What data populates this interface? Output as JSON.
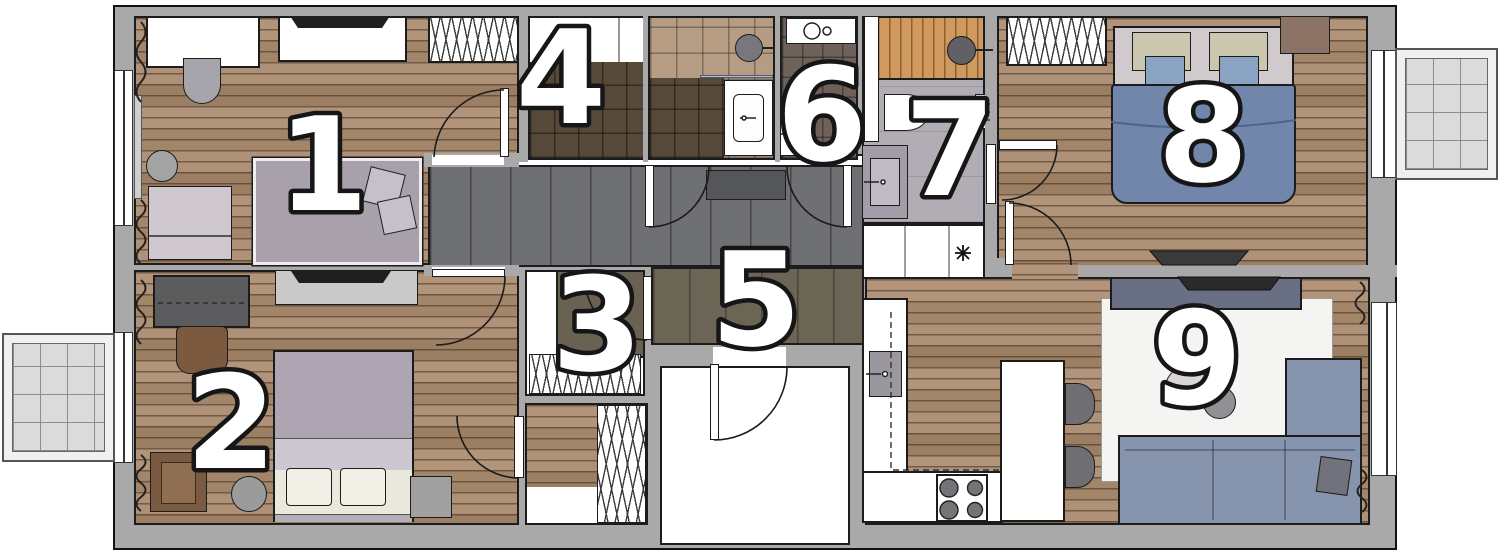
{
  "rooms": [
    {
      "number": "1"
    },
    {
      "number": "2"
    },
    {
      "number": "3"
    },
    {
      "number": "4"
    },
    {
      "number": "5"
    },
    {
      "number": "6"
    },
    {
      "number": "7"
    },
    {
      "number": "8"
    },
    {
      "number": "9"
    }
  ],
  "palette": {
    "wall": "#a9a9a9",
    "wood_floor": "#ab8e72",
    "hallway_floor": "#6f7074",
    "entry_floor": "#6b6556",
    "tile_dark": "#56493a",
    "tile_beige": "#b59c82",
    "tile_taupe": "#6e6159",
    "bath_floor": "#b2adb4",
    "sauna_floor": "#d09a5e",
    "bed_blue": "#7286ac",
    "sofa_blue": "#8794ad",
    "balcony_tile": "#dbdbdb"
  }
}
